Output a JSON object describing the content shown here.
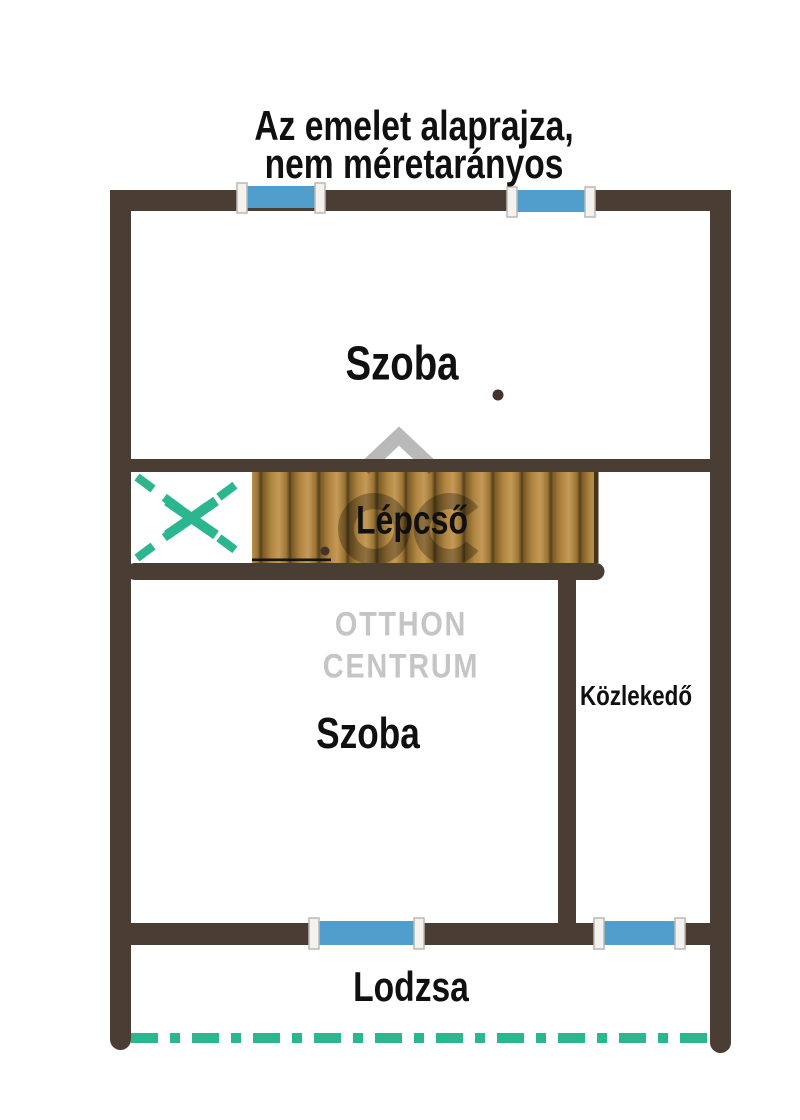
{
  "title": {
    "line1": "Az emelet alaprajza,",
    "line2": "nem méretarányos"
  },
  "rooms": {
    "room_upper": "Szoba",
    "room_lower": "Szoba",
    "stairs": "Lépcső",
    "corridor": "Közlekedő",
    "loggia": "Lodzsa"
  },
  "watermark": {
    "line1": "OTTHON",
    "line2": "CENTRUM"
  },
  "colors": {
    "wall": "#4a3d33",
    "window_blue": "#4f9ecb",
    "accent_teal": "#2cb690",
    "wood_light": "#c59a58",
    "wood_dark": "#54401b",
    "watermark_gray": "#b9b9b9",
    "watermark_text": "#c5c5c5",
    "label": "#101010"
  }
}
